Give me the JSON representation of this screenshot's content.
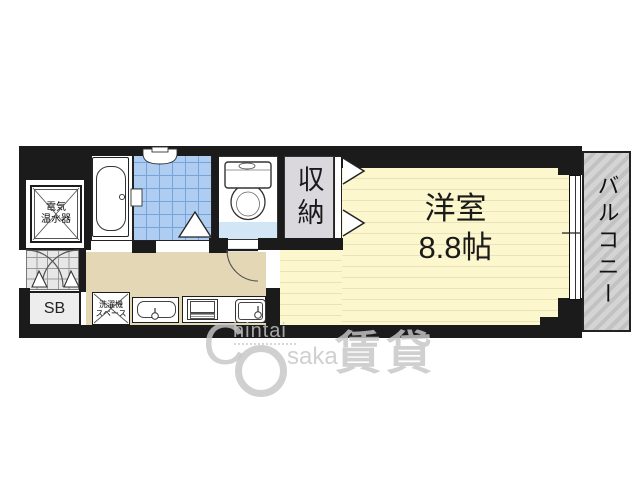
{
  "floor_plan": {
    "kind": "apartment-floor-plan",
    "rooms": {
      "main_room": {
        "name": "洋室",
        "size": "8.8帖"
      },
      "balcony": {
        "name": "バルコニー"
      },
      "closet": {
        "name": "収納"
      },
      "water_heater": {
        "line1": "電気",
        "line2": "温水器"
      },
      "shoe_box": {
        "label": "SB"
      },
      "washing_machine": {
        "line1": "洗濯機",
        "line2": "スペース"
      }
    },
    "colors": {
      "wall": "#1b1b1b",
      "room-floor": "#fcf7cd",
      "room-stripe": "#e9e2bc",
      "kitchen-floor": "#e4d7b6",
      "bath-tile": "#aecdf0",
      "bath-tile-line": "#76a3da",
      "toilet-floor": "#d3e6f6",
      "closet-floor": "#dad7dd",
      "genkan-tile": "#e7e7e7",
      "genkan-line": "#9a9a9a",
      "watermark": "#c6c6c6"
    },
    "watermark": {
      "c": "C",
      "hintai": "hintai",
      "saka": "saka",
      "kanji": "賃貸"
    }
  }
}
